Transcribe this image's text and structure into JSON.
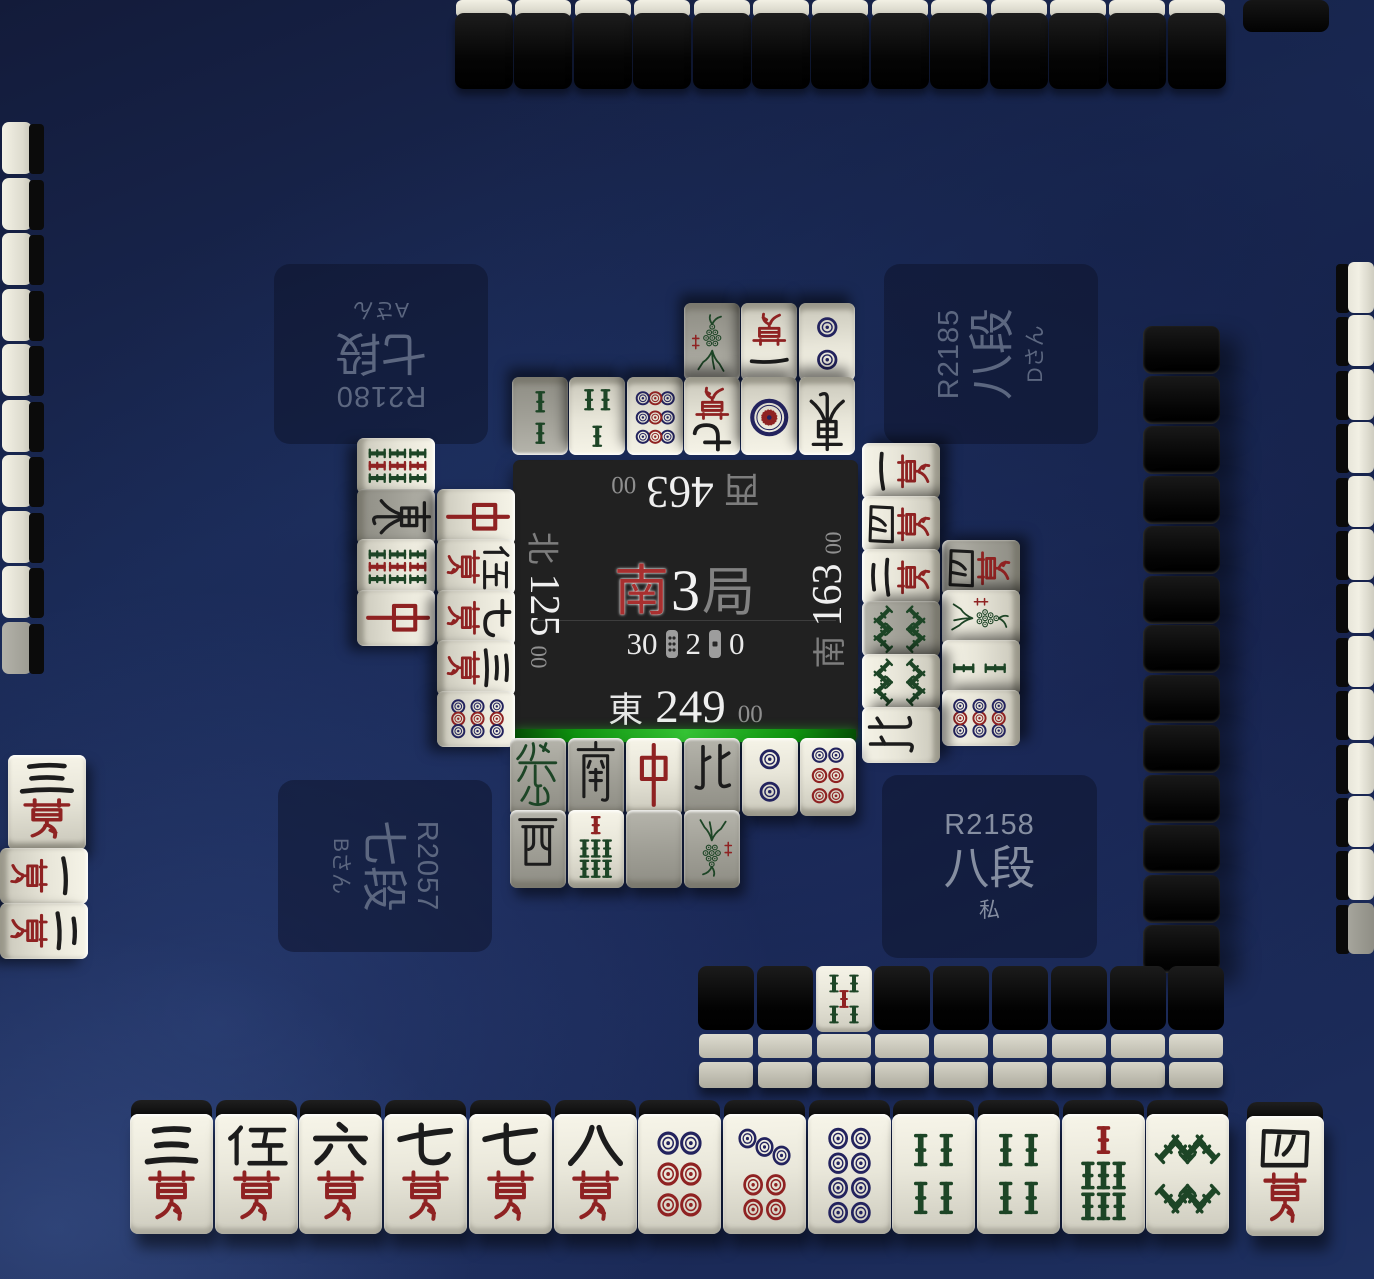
{
  "center_panel": {
    "round": {
      "wind": "南",
      "number": "3",
      "suffix": "局"
    },
    "info_row": {
      "tiles_remaining": "30",
      "honba_count": "2",
      "riichi_sticks": "0"
    },
    "scores": {
      "top": {
        "wind": "西",
        "value": "463",
        "cents": "00"
      },
      "left": {
        "wind": "北",
        "value": "125",
        "cents": "00"
      },
      "right": {
        "wind": "南",
        "value": "163",
        "cents": "00"
      },
      "bottom": {
        "wind": "東",
        "value": "249",
        "cents": "00"
      }
    }
  },
  "players": {
    "top": {
      "rating": "R2180",
      "rank": "七段",
      "name": "Aさん"
    },
    "right": {
      "rating": "R2185",
      "rank": "八段",
      "name": "Dさん"
    },
    "left": {
      "rating": "R2057",
      "rank": "七段",
      "name": "Bさん"
    },
    "bottom": {
      "rating": "R2158",
      "rank": "八段",
      "name": "私"
    }
  },
  "hand": {
    "tiles": [
      "3m",
      "5m",
      "6m",
      "7m",
      "7m",
      "8m",
      "6p",
      "7p",
      "8p",
      "4s",
      "4s",
      "7s",
      "8s"
    ],
    "drawn_tile": "4m"
  },
  "discards": {
    "grey_marker_note": "* = dimmed (tsumogiri) tile",
    "top": {
      "rows": [
        [
          "2s*",
          "3s",
          "9p",
          "9m",
          "1p",
          "E"
        ],
        [
          null,
          null,
          null,
          "1s*",
          "1m",
          "2p"
        ]
      ]
    },
    "left": {
      "cols": [
        [
          "9s",
          "E*",
          "9s",
          "C"
        ],
        [
          null,
          "C",
          "5m",
          "9m",
          "3m",
          "9p"
        ]
      ]
    },
    "right": {
      "cols": [
        [
          "1m",
          "4m",
          "2m",
          "8s*",
          "8s",
          "N"
        ],
        [
          "4m*",
          "1s",
          "2s",
          "9p"
        ]
      ]
    },
    "bottom": {
      "rows": [
        [
          "F*",
          "S*",
          "C",
          "N*",
          "2p",
          "6p"
        ],
        [
          "W*",
          "7s",
          "P*",
          "1s*"
        ]
      ]
    }
  },
  "meld_bottom_left": {
    "tiles": [
      {
        "code": "3m",
        "rotated": false
      },
      {
        "code": "1m",
        "rotated": true
      },
      {
        "code": "2m",
        "rotated": true
      }
    ]
  },
  "walls": {
    "top_count": 13,
    "left_count": 10,
    "right_outer_count": 13,
    "right_inner_count": 13,
    "bottom_count": 9,
    "bottom_face_up": {
      "index": 2,
      "tile": "5s"
    }
  },
  "tile_legend": {
    "1m": "一萬",
    "2m": "二萬",
    "3m": "三萬",
    "4m": "四萬",
    "5m": "伍萬",
    "6m": "六萬",
    "7m": "七萬",
    "8m": "八萬",
    "9m": "九萬",
    "1p": "一筒",
    "2p": "二筒",
    "6p": "六筒",
    "7p": "七筒",
    "8p": "八筒",
    "9p": "九筒",
    "1s": "一索",
    "2s": "二索",
    "3s": "三索",
    "4s": "四索",
    "5s": "五索",
    "7s": "七索",
    "8s": "八索",
    "9s": "九索",
    "E": "東",
    "S": "南",
    "W": "西",
    "N": "北",
    "P": "白",
    "F": "發",
    "C": "中"
  },
  "colors": {
    "turn_indicator": "#22b522",
    "tile_ivory": "#e9e7da",
    "tile_grey": "#a3a29a",
    "pin_blue": "#23235e",
    "dragon_red": "#8f2222",
    "bamboo_green": "#1d4526",
    "ink_black": "#1c1c1c",
    "panel_text": "#5c6780"
  }
}
